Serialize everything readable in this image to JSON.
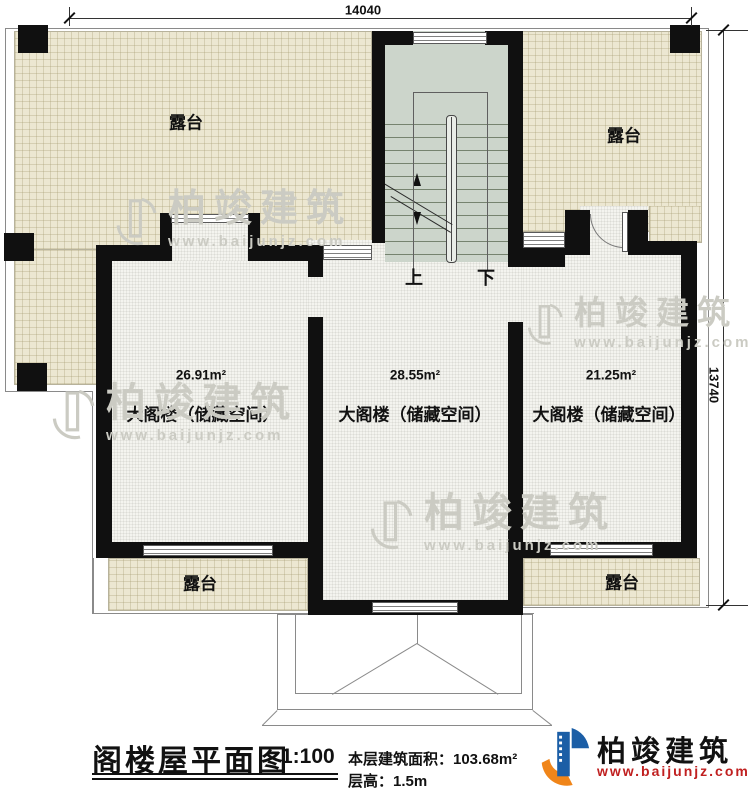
{
  "dimensions": {
    "top": "14040",
    "right": "13740"
  },
  "terraces": {
    "top_left": "露台",
    "top_right": "露台",
    "bottom_left": "露台",
    "bottom_right": "露台"
  },
  "rooms": [
    {
      "area": "26.91m²",
      "name": "大阁楼（储藏空间）"
    },
    {
      "area": "28.55m²",
      "name": "大阁楼（储藏空间）"
    },
    {
      "area": "21.25m²",
      "name": "大阁楼（储藏空间）"
    }
  ],
  "stairs": {
    "up": "上",
    "down": "下"
  },
  "title_block": {
    "title": "阁楼屋平面图",
    "scale": "1:100",
    "floor_area": "本层建筑面积：103.68m²",
    "floor_height": "层高：1.5m",
    "brand": "柏竣建筑",
    "website": "www.baijunjz.com"
  },
  "watermark": {
    "brand": "柏竣建筑",
    "website": "www.baijunjz.com"
  },
  "colors": {
    "terrace_fill": "#ece7d1",
    "stair_fill": "#ccd5cb",
    "wall": "#101010",
    "logo_blue": "#1b5ea6",
    "logo_orange": "#f08519",
    "url_red": "#c02020"
  }
}
